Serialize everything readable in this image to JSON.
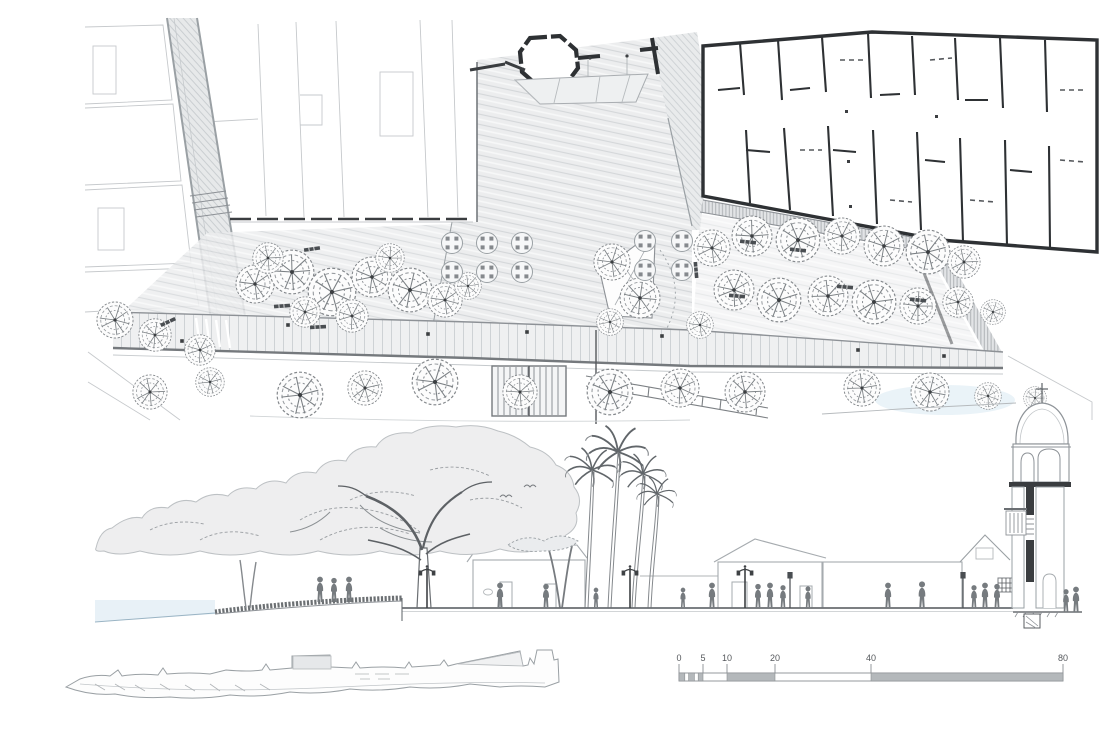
{
  "sheet": {
    "kind": "architectural plan and section drawing",
    "panels": [
      "site-plan",
      "street-elevation-section",
      "longitudinal-profile-sketch",
      "graphic-scale-bar"
    ]
  },
  "scale_bar": {
    "labels": [
      "0",
      "5",
      "10",
      "20",
      "40",
      "80"
    ]
  },
  "colors": {
    "paper": "#ffffff",
    "wall_black": "#2e3134",
    "dark_line": "#55585c",
    "mid_line": "#8d9196",
    "light_line": "#c5c9cc",
    "paving_gray": "#ebedee",
    "foliage_fill": "#eeeeef",
    "water_blue": "#dfecf4"
  }
}
